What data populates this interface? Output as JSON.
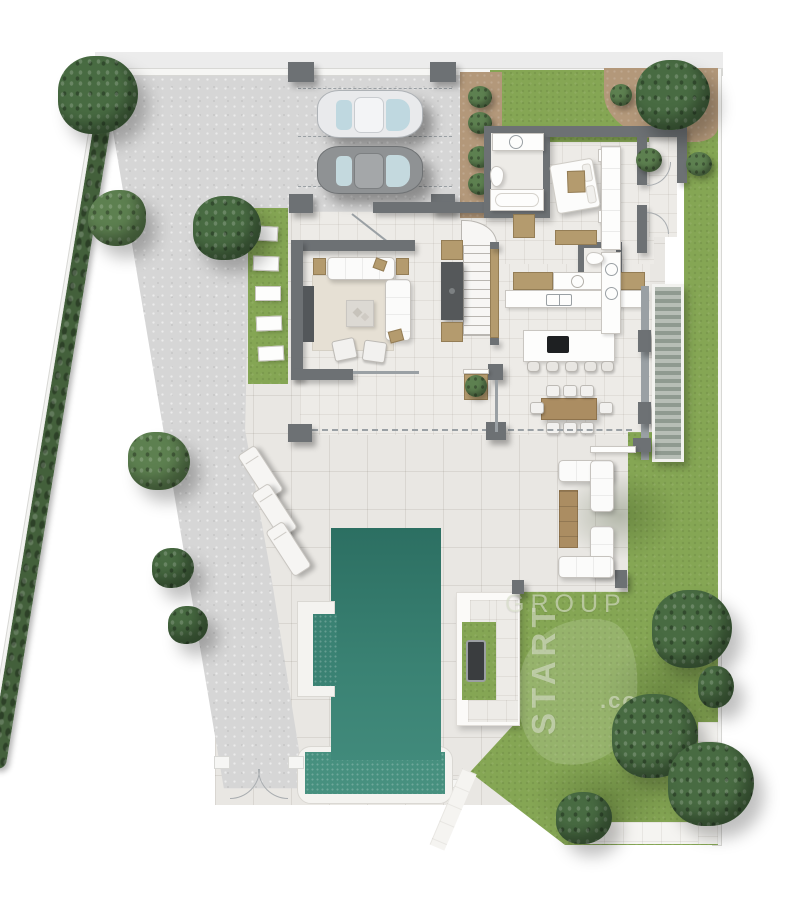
{
  "watermark": {
    "top": "GROUP",
    "side": "START",
    "suffix": ".com"
  },
  "colors": {
    "page": "#ffffff",
    "street": "#ececec",
    "boundary": "#f6f6f4",
    "boundary_edge": "#d8d8d5",
    "driveway": "#d6d6d6",
    "paving": "#e9e7e3",
    "interior": "#edebe7",
    "wall": "#6d7174",
    "wall_dark": "#55585a",
    "wood": "#b49b6e",
    "wood_dark": "#ab8d62",
    "lawn": "#85a654",
    "lawn_dark": "#70924a",
    "hedge": "#43603b",
    "tree": "#486b42",
    "tree_light": "#5d8050",
    "soil": "#b3987a",
    "pool": "#2e7466",
    "pool_light": "#47907f",
    "fixture": "#fdfdfc",
    "fixture_edge": "#c9c6c1",
    "glass": "#9aa0a4",
    "cooktop": "#1e2022",
    "car_silver": "#e9eaec",
    "car_gray": "#8f9294",
    "car_glass": "#bfd8e0",
    "watermark": "rgba(219,226,205,0.62)"
  },
  "counts": {
    "cars": 2,
    "carport_pillars": 4,
    "sun_loungers": 3,
    "bar_stools": 5,
    "dining_chairs": 8,
    "outdoor_sofas": 2,
    "gate_leaves": 2,
    "pools": 1
  }
}
